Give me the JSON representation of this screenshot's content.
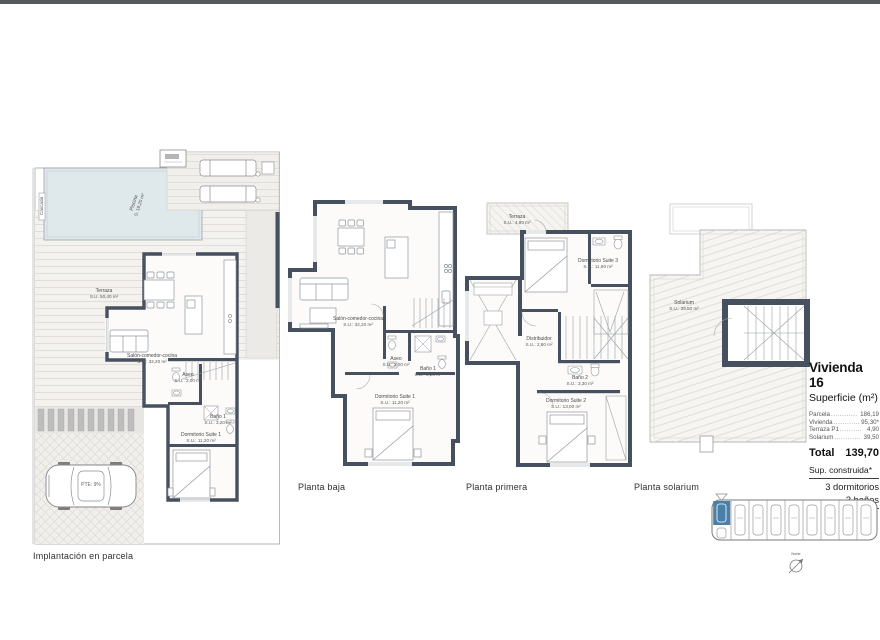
{
  "site": {
    "caption": "Implantación en parcela",
    "piscina": {
      "name": "Piscina",
      "area": "S: 18,20 m²"
    },
    "cascada": "Cascada",
    "terraza": {
      "name": "Terraza",
      "area": "S.U. 50,40 m²"
    },
    "salon": {
      "name": "Salón-comedor-cocina",
      "area": "S.U.: 32,20 m²"
    },
    "aseo": {
      "name": "Aseo",
      "area": "S.U.: 2,00 m²"
    },
    "bano1": {
      "name": "Baño 1",
      "area": "S.U.: 3,20 m²"
    },
    "dorm1": {
      "name": "Dormitorio Suite 1",
      "area": "S.U.: 11,20 m²"
    },
    "pendiente": "PTE: 9%"
  },
  "baja": {
    "caption": "Planta baja",
    "salon": {
      "name": "Salón-comedor-cocina",
      "area": "S.U.: 32,20 m²"
    },
    "aseo": {
      "name": "Aseo",
      "area": "S.U.: 2,00 m²"
    },
    "bano1": {
      "name": "Baño 1",
      "area": "S.U.: 3,20 m²"
    },
    "dorm1": {
      "name": "Dormitorio Suite 1",
      "area": "S.U.: 11,20 m²"
    }
  },
  "primera": {
    "caption": "Planta primera",
    "terraza": {
      "name": "Terraza",
      "area": "S.U.: 4,90 m²"
    },
    "dorm3": {
      "name": "Dormitorio Suite 3",
      "area": "S.U.: 11,80 m²"
    },
    "distribuidor": {
      "name": "Distribuidor",
      "area": "S.U.: 2,80 m²"
    },
    "bano2": {
      "name": "Baño 2",
      "area": "S.U.: 3,30 m²"
    },
    "dorm2": {
      "name": "Dormitorio Suite 2",
      "area": "S.U.: 13,00 m²"
    }
  },
  "solarium": {
    "caption": "Planta solarium",
    "room": {
      "name": "Solarium",
      "area": "S.U.: 39,50 m²"
    }
  },
  "panel": {
    "title": "Vivienda 16",
    "subtitle": "Superficie (m²)",
    "rows": [
      {
        "label": "Parcela",
        "dots": "............",
        "value": "186,19"
      },
      {
        "label": "Vivienda",
        "dots": "............",
        "value": "95,30*"
      },
      {
        "label": "Terraza P1",
        "dots": "..........",
        "value": "4,90"
      },
      {
        "label": "Solarium",
        "dots": "............",
        "value": "39,50"
      }
    ],
    "total_label": "Total",
    "total_value": "139,70",
    "built_label": "Sup. construida*",
    "bedrooms": "3 dormitorios",
    "bathrooms": "3 baños"
  },
  "keyplan": {
    "north": "Norte"
  },
  "colors": {
    "wall": "#46505e",
    "pool": "#dfe9ec",
    "accent_blue": "#4a7fa8",
    "topbar": "#57585a"
  }
}
